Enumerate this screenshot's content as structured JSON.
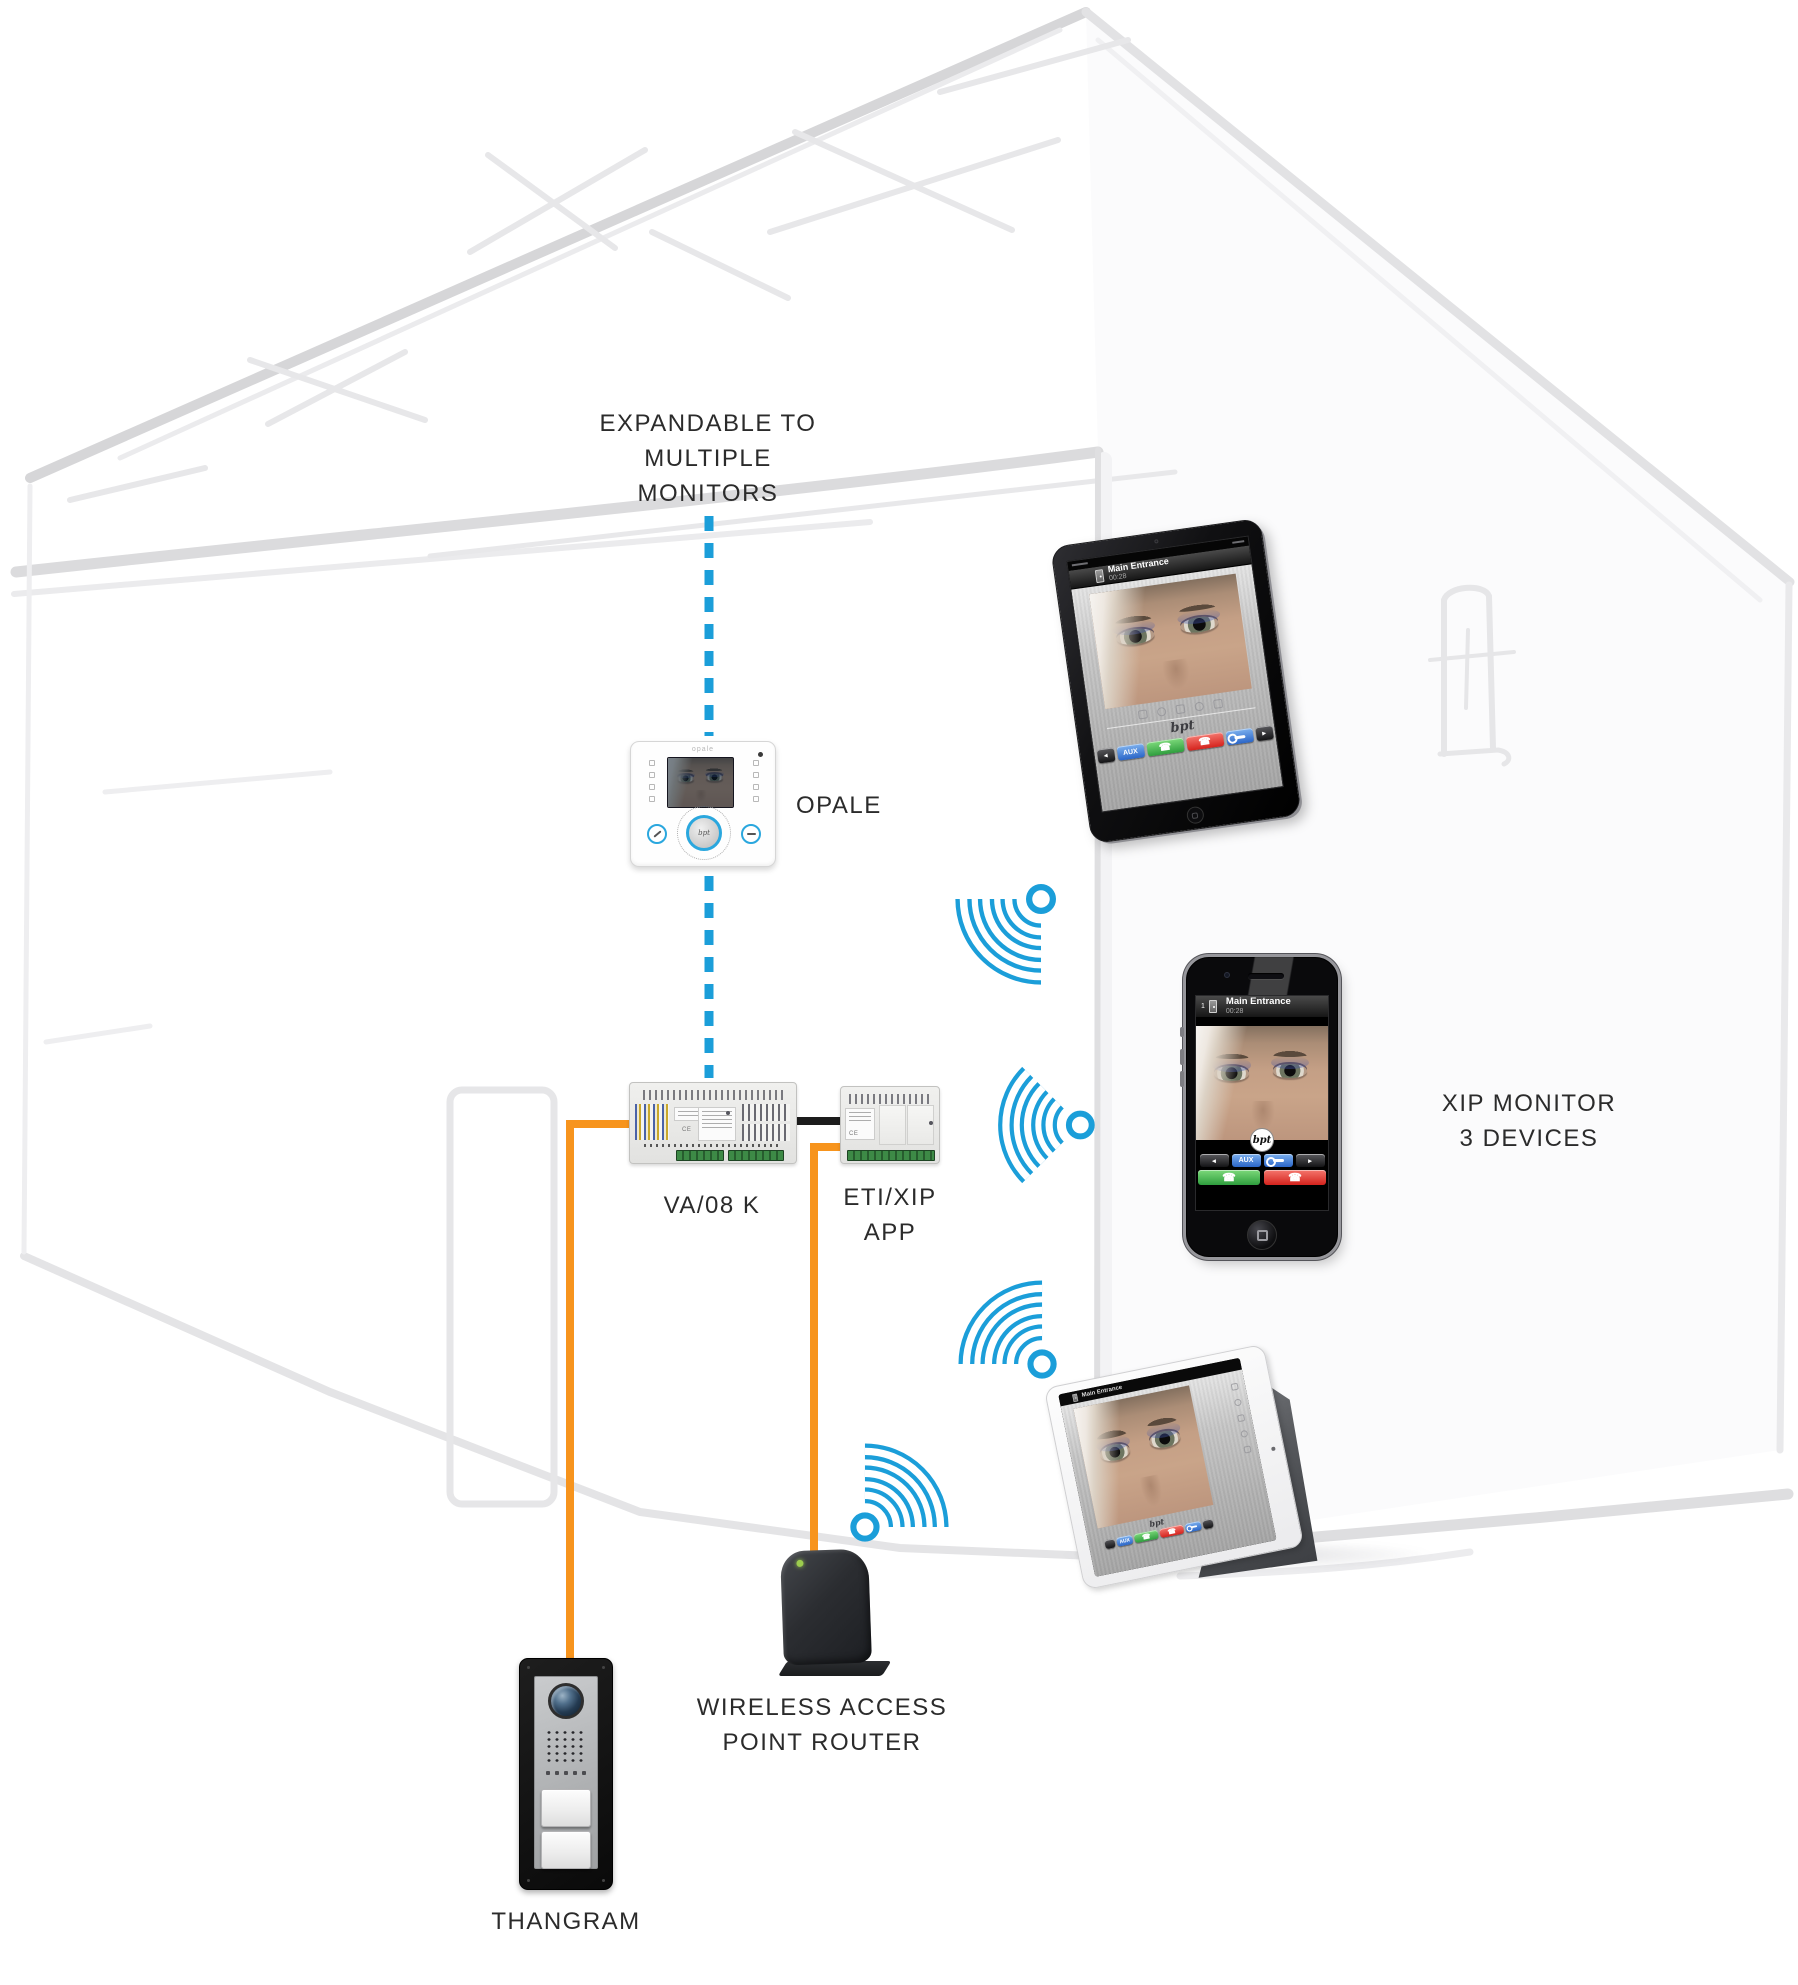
{
  "labels": {
    "expandable": [
      "EXPANDABLE TO",
      "MULTIPLE",
      "MONITORS"
    ],
    "monitor": "OPALE",
    "monitor_print": "opale",
    "power_unit": "VA/08 K",
    "gateway_line1": "ETI/XIP",
    "gateway_line2": "APP",
    "devices_line1": "XIP MONITOR",
    "devices_line2": "3 DEVICES",
    "router_line1": "WIRELESS ACCESS",
    "router_line2": "POINT ROUTER",
    "entry_panel": "THANGRAM"
  },
  "call_ui": {
    "title": "Main Entrance",
    "timer": "00:28",
    "badge": "1",
    "aux": "AUX",
    "brand": "bpt"
  },
  "icons": {
    "prev": "◂",
    "next": "▸",
    "phone": "☎"
  },
  "colors": {
    "wifi_blue": "#1B9ED9",
    "wire_orange": "#F7941D",
    "label_text": "#2B2B2B",
    "button_green": "#3BB54A",
    "button_red": "#E8312A",
    "button_blue": "#2F6FD0"
  }
}
